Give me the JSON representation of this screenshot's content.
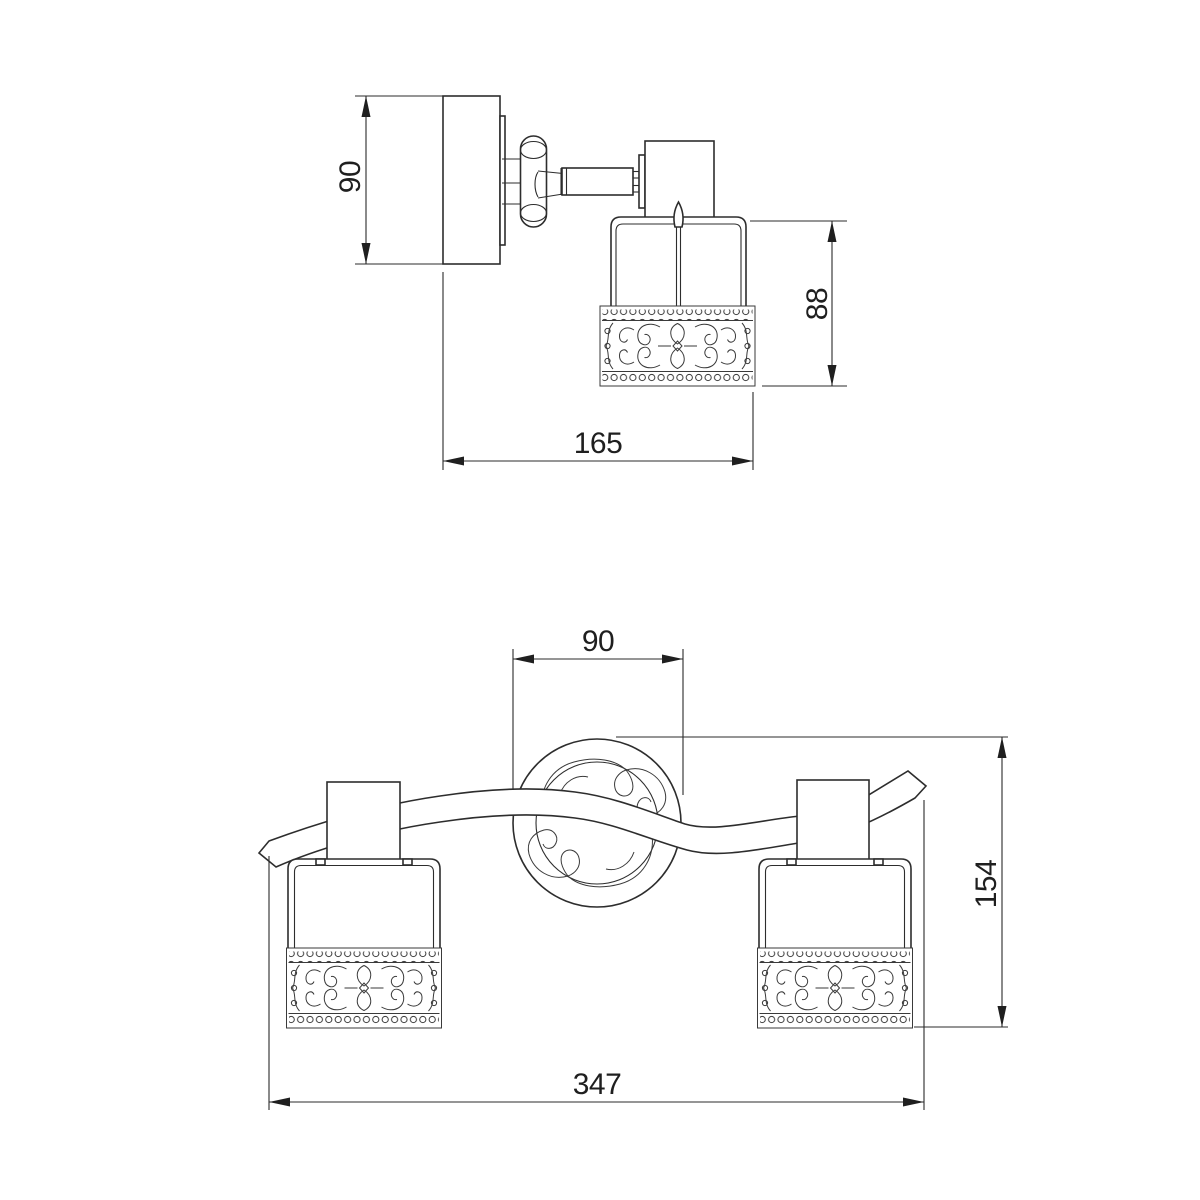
{
  "drawing": {
    "background": "#ffffff",
    "line_color": "#2d2d2d",
    "dim_text_color": "#1f1f1f",
    "views": {
      "side": {
        "dims": {
          "backplate_height": "90",
          "shade_height": "88",
          "projection": "165"
        }
      },
      "front": {
        "dims": {
          "canopy_width": "90",
          "fixture_height": "154",
          "overall_width": "347"
        }
      }
    }
  }
}
